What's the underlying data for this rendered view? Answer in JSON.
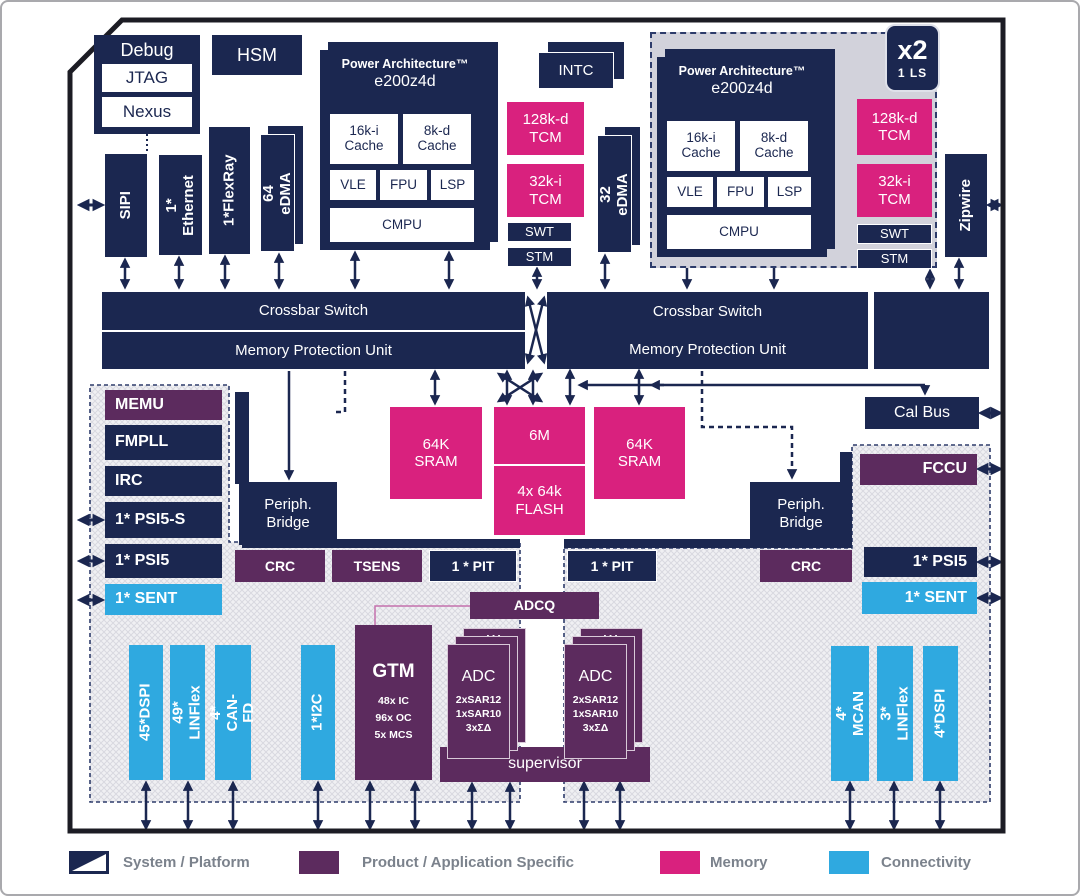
{
  "badge": {
    "count": "x2",
    "mode": "1 LS"
  },
  "debug": {
    "title": "Debug",
    "jtag": "JTAG",
    "nexus": "Nexus"
  },
  "hsm": "HSM",
  "intc": "INTC",
  "core": {
    "arch": "Power Architecture™",
    "model": "e200z4d",
    "icache": "16k-i\nCache",
    "dcache": "8k-d\nCache",
    "vle": "VLE",
    "fpu": "FPU",
    "lsp": "LSP",
    "cmpu": "CMPU",
    "tcm_d": "128k-d\nTCM",
    "tcm_i": "32k-i\nTCM",
    "swt": "SWT",
    "stm": "STM"
  },
  "io": {
    "sipi": "SIPI",
    "ethernet": "1*\nEthernet",
    "flexray": "1*FlexRay",
    "edma64": "64 eDMA",
    "edma32": "32 eDMA",
    "zipwire": "Zipwire",
    "calbus": "Cal Bus"
  },
  "crossbar": {
    "switch": "Crossbar Switch",
    "mpu": "Memory Protection Unit"
  },
  "memory": {
    "sram": "64K\nSRAM",
    "flash_size": "6M",
    "flash_cfg": "4x 64k\nFLASH"
  },
  "system_left": {
    "memu": "MEMU",
    "fmpll": "FMPLL",
    "irc": "IRC",
    "psi5_s": "1* PSI5-S",
    "psi5": "1* PSI5",
    "sent": "1* SENT"
  },
  "system_right": {
    "fccu": "FCCU",
    "psi5": "1* PSI5",
    "sent": "1* SENT"
  },
  "periph": {
    "bridge": "Periph.\nBridge",
    "crc": "CRC",
    "tsens": "TSENS",
    "pit": "1 * PIT",
    "adcq": "ADCQ",
    "supervisor": "supervisor"
  },
  "gtm": {
    "title": "GTM",
    "channels": "48x IC\n96x OC\n5x MCS"
  },
  "adc": {
    "title": "ADC",
    "config": "2xSAR12\n1xSAR10\n3xΣΔ",
    "more": "..."
  },
  "connectivity_left": {
    "dspi": "45*DSPI",
    "linflex": "49* LINFlex",
    "canfd": "4* CAN-FD",
    "i2c": "1*I2C"
  },
  "connectivity_right": {
    "mcan": "4* MCAN",
    "linflex": "3* LINFlex",
    "dspi": "4*DSPI"
  },
  "legend": {
    "system": "System / Platform",
    "product": "Product / Application Specific",
    "memory": "Memory",
    "connectivity": "Connectivity"
  },
  "colors": {
    "navy": "#1b2750",
    "purple": "#5c2b5e",
    "magenta": "#d9217e",
    "cyan": "#2fa9e0"
  }
}
